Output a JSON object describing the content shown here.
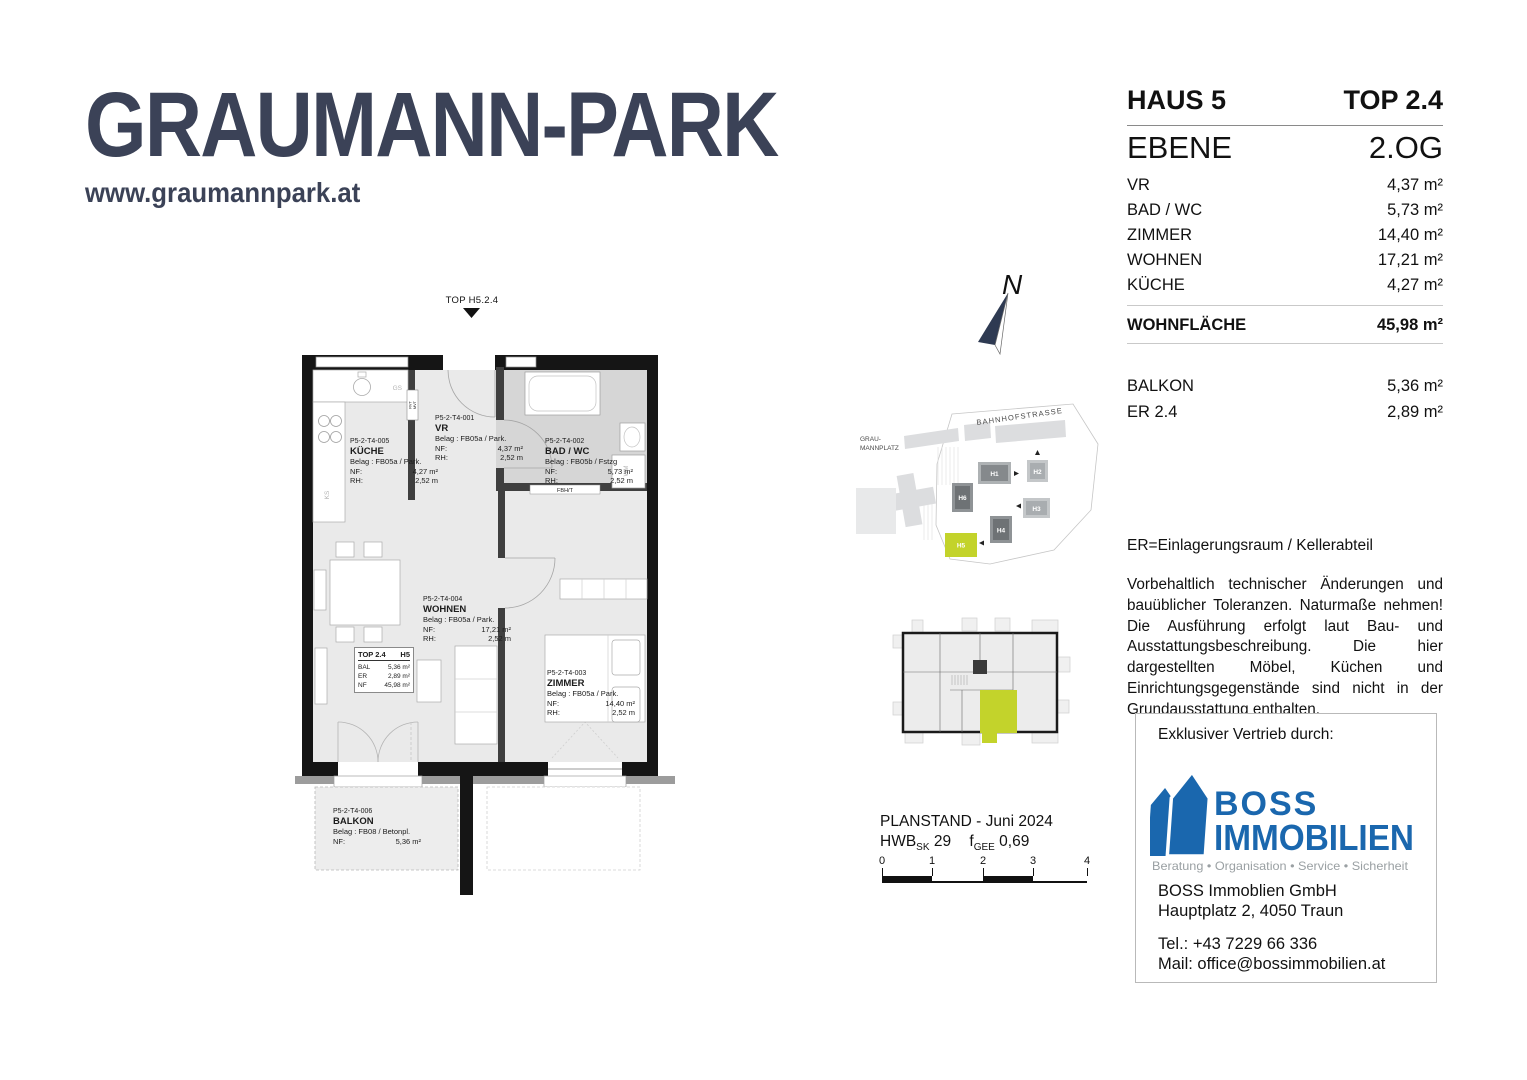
{
  "logo": {
    "title": "GRAUMANN-PARK",
    "website": "www.graumannpark.at",
    "color": "#3b4257"
  },
  "info_panel": {
    "haus": "HAUS 5",
    "top": "TOP 2.4",
    "ebene_label": "EBENE",
    "ebene_value": "2.OG",
    "rooms": [
      {
        "label": "VR",
        "value": "4,37 m²"
      },
      {
        "label": "BAD / WC",
        "value": "5,73 m²"
      },
      {
        "label": "ZIMMER",
        "value": "14,40 m²"
      },
      {
        "label": "WOHNEN",
        "value": "17,21 m²"
      },
      {
        "label": "KÜCHE",
        "value": "4,27 m²"
      }
    ],
    "total_label": "WOHNFLÄCHE",
    "total_value": "45,98 m²",
    "extras": [
      {
        "label": "BALKON",
        "value": "5,36 m²"
      },
      {
        "label": "ER 2.4",
        "value": "2,89 m²"
      }
    ],
    "er_note": "ER=Einlagerungsraum / Kellerabteil",
    "disclaimer": "Vorbehaltlich technischer Änderungen und bauüblicher Toleranzen. Naturmaße nehmen! Die Ausführung erfolgt laut Bau- und Ausstattungsbeschreibung. Die hier dargestellten Möbel, Küchen und Einrichtungsgegenstände sind nicht in der Grundausstattung enthalten."
  },
  "floorplan": {
    "entrance_marker": "TOP H5.2.4",
    "unit_box": {
      "title": "TOP 2.4",
      "haus": "H5",
      "rows": [
        {
          "label": "BAL",
          "value": "5,36 m²"
        },
        {
          "label": "ER",
          "value": "2,89 m²"
        },
        {
          "label": "NF",
          "value": "45,98 m²"
        }
      ]
    },
    "labels": {
      "kueche": {
        "code": "P5-2-T4-005",
        "name": "KÜCHE",
        "belag": "Belag : FB05a / Park.",
        "nf_label": "NF:",
        "nf": "4,27 m²",
        "rh_label": "RH:",
        "rh": "2,52 m"
      },
      "vr": {
        "code": "P5-2-T4-001",
        "name": "VR",
        "belag": "Belag : FB05a / Park.",
        "nf_label": "NF:",
        "nf": "4,37 m²",
        "rh_label": "RH:",
        "rh": "2,52 m"
      },
      "bad": {
        "code": "P5-2-T4-002",
        "name": "BAD / WC",
        "belag": "Belag : FB05b / Fstzg",
        "nf_label": "NF:",
        "nf": "5,73 m²",
        "rh_label": "RH:",
        "rh": "2,52 m"
      },
      "wohnen": {
        "code": "P5-2-T4-004",
        "name": "WOHNEN",
        "belag": "Belag : FB05a / Park.",
        "nf_label": "NF:",
        "nf": "17,21 m²",
        "rh_label": "RH:",
        "rh": "2,52 m"
      },
      "zimmer": {
        "code": "P5-2-T4-003",
        "name": "ZIMMER",
        "belag": "Belag : FB05a / Park.",
        "nf_label": "NF:",
        "nf": "14,40 m²",
        "rh_label": "RH:",
        "rh": "2,52 m"
      },
      "balkon": {
        "code": "P5-2-T4-006",
        "name": "BALKON",
        "belag": "Belag : FB08 / Betonpl.",
        "nf_label": "NF:",
        "nf": "5,36 m²"
      }
    },
    "appliances": {
      "gs": "GS",
      "ks": "KS",
      "wm": "WM",
      "fbht": "FBH/T",
      "rvt": "RVT",
      "mvt": "MVT"
    }
  },
  "north_label": "N",
  "site_plan": {
    "street": "BAHNHOFSTRASSE",
    "platz_line1": "GRAU-",
    "platz_line2": "MANNPLATZ",
    "buildings": [
      {
        "id": "H1"
      },
      {
        "id": "H2"
      },
      {
        "id": "H3"
      },
      {
        "id": "H4"
      },
      {
        "id": "H5"
      },
      {
        "id": "H6"
      }
    ],
    "highlight_color": "#c3d32b"
  },
  "plan_meta": {
    "planstand": "PLANSTAND - Juni 2024",
    "hwb_label": "HWB",
    "hwb_sub": "SK",
    "hwb_value": "29",
    "f_label": "f",
    "f_sub": "GEE",
    "f_value": "0,69",
    "scale_ticks": [
      "0",
      "1",
      "2",
      "3",
      "4"
    ]
  },
  "vendor": {
    "heading": "Exklusiver Vertrieb durch:",
    "brand_line1": "BOSS",
    "brand_line2": "IMMOBILIEN",
    "tagline": "Beratung • Organisation • Service • Sicherheit",
    "company": "BOSS Immoblien GmbH",
    "address": "Hauptplatz 2, 4050 Traun",
    "tel": "Tel.: +43 7229 66 336",
    "mail": "Mail: office@bossimmobilien.at",
    "brand_color": "#1a67ae"
  }
}
